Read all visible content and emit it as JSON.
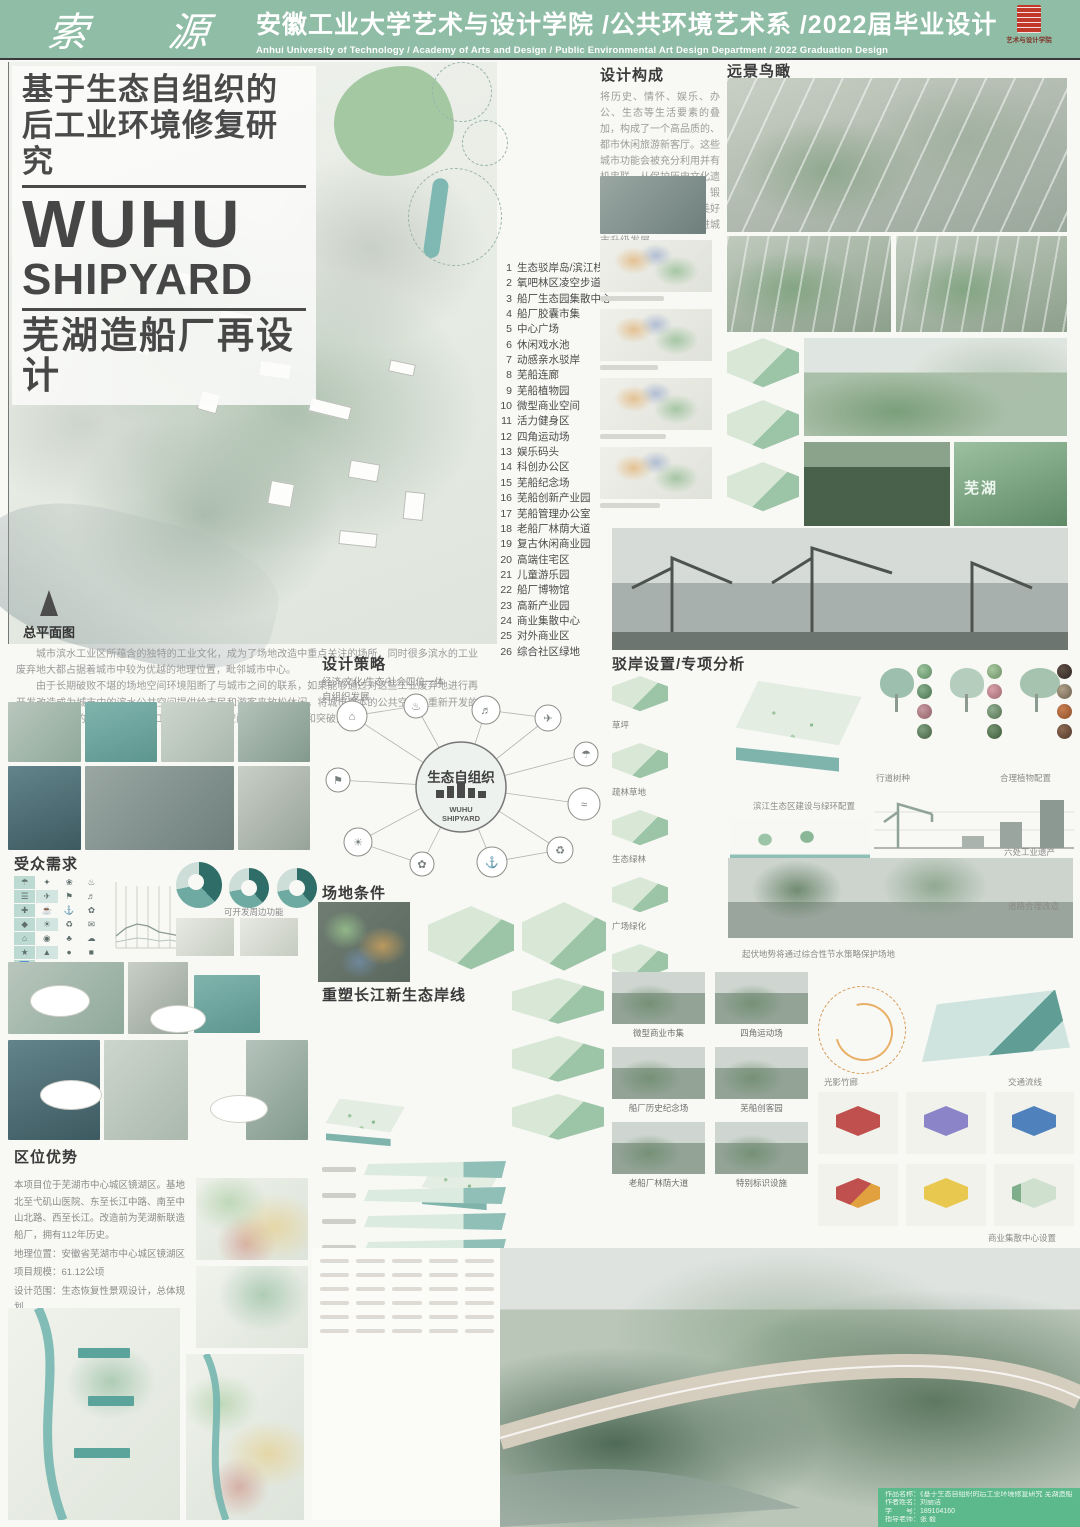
{
  "header": {
    "brand": "索 源",
    "title_cn": "安徽工业大学艺术与设计学院 /公共环境艺术系 /2022届毕业设计",
    "title_en": "Anhui University of Technology / Academy of Arts and Design / Public Environmental Art Design Department / 2022 Graduation Design",
    "seal_caption": "艺术与设计学院"
  },
  "title_block": {
    "line1": "基于生态自组织的",
    "line2": "后工业环境修复研究",
    "en_line1": "WUHU",
    "en_line2": "SHIPYARD",
    "subtitle": "芜湖造船厂再设计"
  },
  "master_plan": {
    "label": "总平面图"
  },
  "legend": {
    "items": [
      {
        "n": "1",
        "t": "生态驳岸岛/滨江栈道"
      },
      {
        "n": "2",
        "t": "氧吧林区凌空步道"
      },
      {
        "n": "3",
        "t": "船厂生态园集散中心"
      },
      {
        "n": "4",
        "t": "船厂胶囊市集"
      },
      {
        "n": "5",
        "t": "中心广场"
      },
      {
        "n": "6",
        "t": "休闲戏水池"
      },
      {
        "n": "7",
        "t": "动感亲水驳岸"
      },
      {
        "n": "8",
        "t": "芜船连廊"
      },
      {
        "n": "9",
        "t": "芜船植物园"
      },
      {
        "n": "10",
        "t": "微型商业空间"
      },
      {
        "n": "11",
        "t": "活力健身区"
      },
      {
        "n": "12",
        "t": "四角运动场"
      },
      {
        "n": "13",
        "t": "娱乐码头"
      },
      {
        "n": "14",
        "t": "科创办公区"
      },
      {
        "n": "15",
        "t": "芜船纪念场"
      },
      {
        "n": "16",
        "t": "芜船创新产业园"
      },
      {
        "n": "17",
        "t": "芜船管理办公室"
      },
      {
        "n": "18",
        "t": "老船厂林荫大道"
      },
      {
        "n": "19",
        "t": "复古休闲商业园"
      },
      {
        "n": "20",
        "t": "高端住宅区"
      },
      {
        "n": "21",
        "t": "儿童游乐园"
      },
      {
        "n": "22",
        "t": "船厂博物馆"
      },
      {
        "n": "23",
        "t": "高新产业园"
      },
      {
        "n": "24",
        "t": "商业集散中心"
      },
      {
        "n": "25",
        "t": "对外商业区"
      },
      {
        "n": "26",
        "t": "综合社区绿地"
      }
    ]
  },
  "intro": {
    "p1": "城市滨水工业区所蕴含的独特的工业文化，成为了场地改造中重点关注的场所，同时很多滨水的工业废弃地大都占据着城市中较为优越的地理位置，毗邻城市中心。",
    "p2": "由于长期破败不堪的场地空间环境阻断了与城市之间的联系，如果能够通过对这些工业废弃地进行再开发改造成为城市中的滨水公共空间提供给市民和游客来放松休闲，将城市原本的公共空间与重新开发的滨水空间有机的结合，将是滨水工业废弃地景观空间开发新的契机和突破点。"
  },
  "sections": {
    "design_composition": {
      "title": "设计构成",
      "body": "将历史、情怀、娱乐、办公、生态等生活要素的叠加，构成了一个高品质的、都市休闲旅游新客厅。这些城市功能会被充分利用并有机串联，从保护历史文化遗迹、注入现代生活方式、锻造文化休闲地标、描绘美好滨江环境多方出发，推进城市升级发展。"
    },
    "distant_view": {
      "title": "远景鸟瞰"
    },
    "audience": {
      "title": "受众需求",
      "caption": "可开发周边功能",
      "icons": [
        "☂",
        "✦",
        "❀",
        "♨",
        "☰",
        "✈",
        "⚑",
        "♬",
        "✚",
        "☕",
        "⚓",
        "✿",
        "◆",
        "☀",
        "♻",
        "✉",
        "⌂",
        "◉",
        "♣",
        "☁",
        "★",
        "▲",
        "●",
        "■",
        "♿",
        "☺",
        "✖",
        "♠"
      ]
    },
    "strategy": {
      "title": "设计策略",
      "sub1": "经济/文化/生态/社会四位一体",
      "sub2": "自组织发展",
      "center_cn": "生态自组织",
      "center_en1": "WUHU",
      "center_en2": "SHIPYARD"
    },
    "site_condition": {
      "title": "场地条件"
    },
    "reshape": {
      "title": "重塑长江新生态岸线"
    },
    "revetment": {
      "title": "驳岸设置/专项分析",
      "veg": [
        "草坪",
        "疏林草地",
        "生态绿林",
        "广场绿化",
        "湿地"
      ],
      "eco": "滨江生态区建设与绿环配置",
      "street_trees": "行道树种",
      "planting": "合理植物配置",
      "heritage": "六处工业遗产",
      "road": "道路合理改造",
      "terrain": "起伏地势将通过综合性节水策略保护场地"
    },
    "location": {
      "title": "区位优势",
      "p1": "本项目位于芜湖市中心城区镜湖区。基地北至弋矶山医院、东至长江中路、南至中山北路、西至长江。改造前为芜湖新联造船厂，拥有112年历史。",
      "l1": "地理位置：安徽省芜湖市中心城区镜湖区",
      "l2": "项目规模：61.12公顷",
      "l3": "设计范围：生态恢复性景观设计，总体规划"
    }
  },
  "renders": {
    "labels": [
      "微型商业市集",
      "四角运动场",
      "船厂历史纪念场",
      "芜船创客园",
      "老船厂林荫大道",
      "特别标识设施"
    ]
  },
  "labels": {
    "bamboo": "光影竹廊",
    "traffic": "交通流线",
    "commercial": "商业集散中心设置"
  },
  "photos": {
    "sign_text": "芜湖"
  },
  "credits": {
    "lines": [
      "作品名称：《基于生态自组织的后工业环境修复研究 芜湖造船厂再设计》",
      "作者姓名：刘丽洁",
      "学　　号：189104160",
      "指导老师：张 毅"
    ]
  },
  "colors": {
    "header_green": "#8fbda6",
    "accent_teal": "#5ba49c",
    "credit_green": "#5cb98c",
    "logo_red": "#c0392b"
  }
}
